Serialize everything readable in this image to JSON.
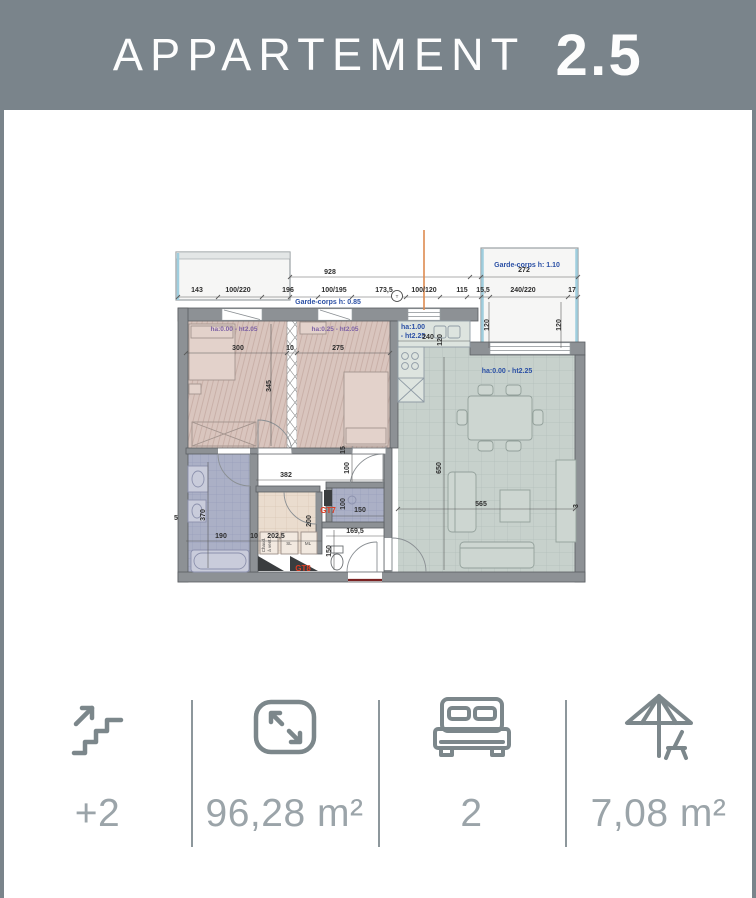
{
  "header": {
    "title": "APPARTEMENT",
    "number": "2.5"
  },
  "colors": {
    "banner": "#7A848B",
    "card": "#FFFFFF",
    "stat_text": "#9BA4A9",
    "icon_stroke": "#7C878B",
    "divider": "#8D979C",
    "dim_text": "#2E2E2E",
    "blue_label": "#2B50A5",
    "purple_label": "#7D61A5",
    "red_label": "#E03C22",
    "bedroom_fill": "#D9C5BE",
    "living_fill": "#C7D1CC",
    "bath_fill": "#ABB0C6",
    "tech_fill": "#EADCCE",
    "wall": "#8D9195",
    "balcony_glass": "#9FCEDE",
    "entry_marker": "#7B2222",
    "orange_line": "#DD8A50"
  },
  "stats": {
    "floor": {
      "label": "+2",
      "icon": "stairs-up"
    },
    "area": {
      "label": "96,28 m²",
      "icon": "expand"
    },
    "bedrooms": {
      "label": "2",
      "icon": "double-bed"
    },
    "outdoor": {
      "label": "7,08 m²",
      "icon": "parasol-chair"
    }
  },
  "plan": {
    "labels": [
      {
        "t": "928",
        "x": 330,
        "y": 164
      },
      {
        "t": "272",
        "x": 524,
        "y": 162
      },
      {
        "t": "143",
        "x": 197,
        "y": 182
      },
      {
        "t": "100/220",
        "x": 238,
        "y": 182
      },
      {
        "t": "196",
        "x": 288,
        "y": 182
      },
      {
        "t": "100/195",
        "x": 334,
        "y": 182
      },
      {
        "t": "173,5",
        "x": 384,
        "y": 182
      },
      {
        "t": "100/120",
        "x": 424,
        "y": 182
      },
      {
        "t": "115",
        "x": 462,
        "y": 182
      },
      {
        "t": "15,5",
        "x": 483,
        "y": 182
      },
      {
        "t": "240/220",
        "x": 523,
        "y": 182
      },
      {
        "t": "17",
        "x": 572,
        "y": 182
      },
      {
        "t": "120",
        "x": 489,
        "y": 215,
        "r": -90
      },
      {
        "t": "120",
        "x": 561,
        "y": 215,
        "r": -90
      },
      {
        "t": "Garde-corps h: 0.85",
        "x": 328,
        "y": 194,
        "c": "blue"
      },
      {
        "t": "Garde-corps h: 1.10",
        "x": 527,
        "y": 157,
        "c": "blue"
      },
      {
        "t": "ha:0.00 - ht2.05",
        "x": 234,
        "y": 221,
        "c": "purple"
      },
      {
        "t": "ha:0.25 - ht2.05",
        "x": 335,
        "y": 221,
        "c": "purple"
      },
      {
        "t": "ha:1.00",
        "x": 413,
        "y": 219,
        "c": "blue"
      },
      {
        "t": "- ht2.25",
        "x": 413,
        "y": 228,
        "c": "blue"
      },
      {
        "t": "ha:0.00 - ht2.25",
        "x": 507,
        "y": 263,
        "c": "blue"
      },
      {
        "t": "300",
        "x": 238,
        "y": 240
      },
      {
        "t": "10",
        "x": 290,
        "y": 240
      },
      {
        "t": "275",
        "x": 338,
        "y": 240
      },
      {
        "t": "345",
        "x": 271,
        "y": 276,
        "r": -90
      },
      {
        "t": "240",
        "x": 428,
        "y": 229
      },
      {
        "t": "120",
        "x": 442,
        "y": 230,
        "r": -90
      },
      {
        "t": "650",
        "x": 441,
        "y": 358,
        "r": -90
      },
      {
        "t": "565",
        "x": 481,
        "y": 396
      },
      {
        "t": "3",
        "x": 578,
        "y": 396,
        "r": -90
      },
      {
        "t": "382",
        "x": 286,
        "y": 367
      },
      {
        "t": "15",
        "x": 345,
        "y": 340,
        "r": -90
      },
      {
        "t": "100",
        "x": 349,
        "y": 358,
        "r": -90
      },
      {
        "t": "370",
        "x": 205,
        "y": 405,
        "r": -90
      },
      {
        "t": "5",
        "x": 176,
        "y": 410
      },
      {
        "t": "190",
        "x": 221,
        "y": 428
      },
      {
        "t": "10",
        "x": 254,
        "y": 428
      },
      {
        "t": "202,5",
        "x": 276,
        "y": 428
      },
      {
        "t": "200",
        "x": 311,
        "y": 411,
        "r": -90
      },
      {
        "t": "100",
        "x": 345,
        "y": 394,
        "r": -90
      },
      {
        "t": "150",
        "x": 360,
        "y": 402
      },
      {
        "t": "169,5",
        "x": 355,
        "y": 423
      },
      {
        "t": "150",
        "x": 331,
        "y": 441,
        "r": -90
      },
      {
        "t": "GT7",
        "x": 328,
        "y": 403,
        "c": "red"
      },
      {
        "t": "GT8",
        "x": 303,
        "y": 461,
        "c": "red"
      },
      {
        "t": "Chaud.",
        "x": 265,
        "y": 435,
        "c": "tiny",
        "r": -90
      },
      {
        "t": "à vent.",
        "x": 271,
        "y": 435,
        "c": "tiny",
        "r": -90
      },
      {
        "t": "SL",
        "x": 289,
        "y": 435,
        "c": "tiny"
      },
      {
        "t": "ML",
        "x": 308,
        "y": 435,
        "c": "tiny"
      },
      {
        "t": "T",
        "x": 397,
        "y": 188,
        "c": "tiny"
      }
    ]
  }
}
